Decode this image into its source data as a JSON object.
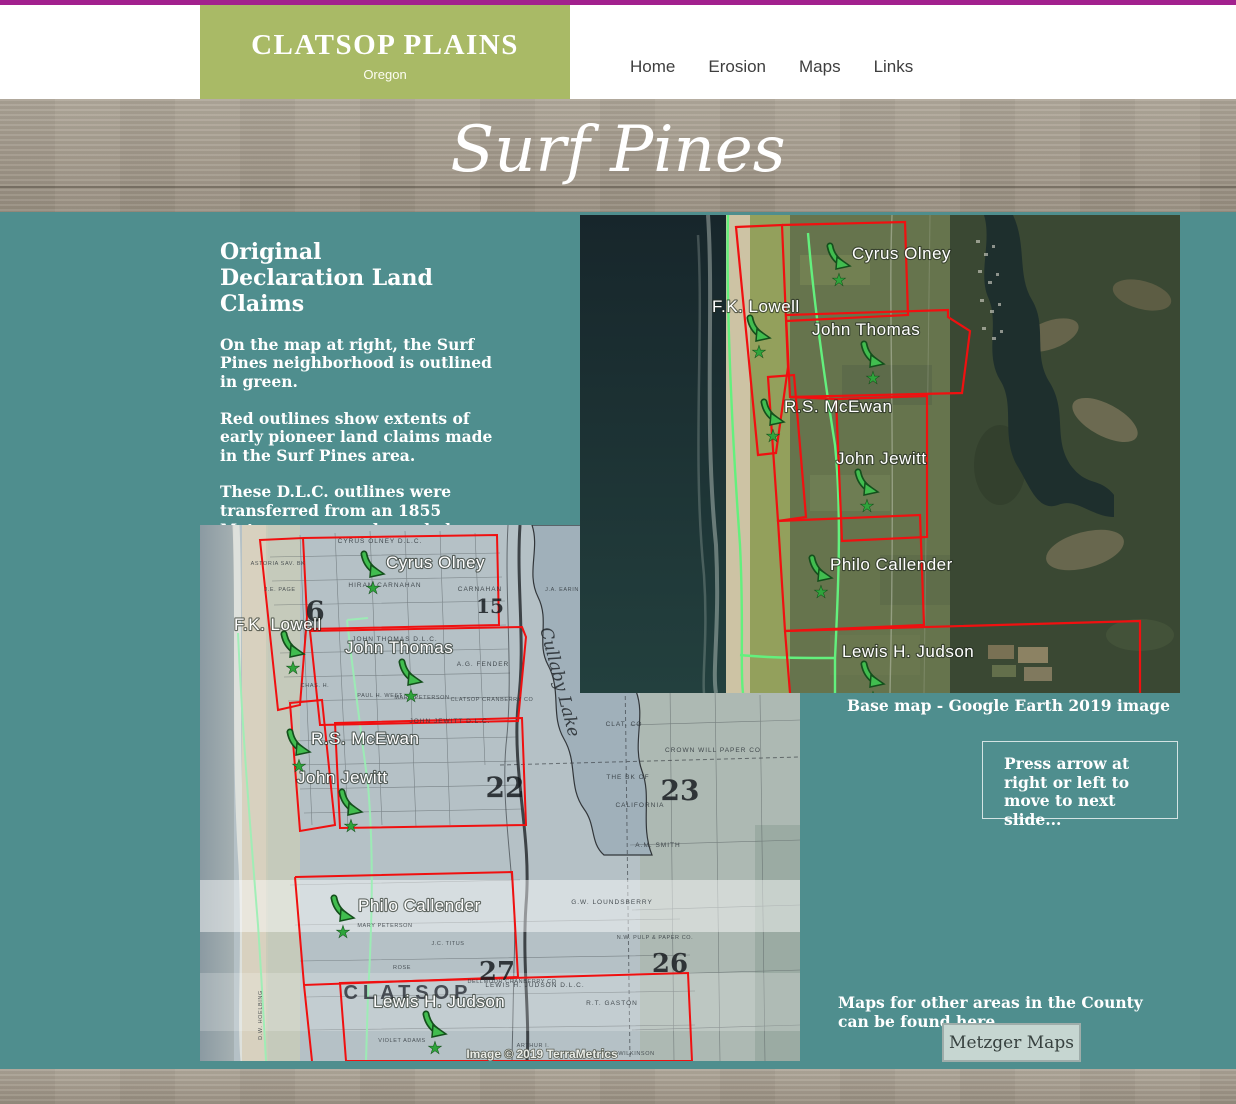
{
  "colors": {
    "teal_bg": "#4f8e8e",
    "olive_brand": "#a9ba66",
    "magenta_topline": "#a2218e",
    "wood": "#a59d90",
    "claim_red": "#f01010",
    "neighborhood_green": "#63f07d",
    "button_bg": "#c6d6d1",
    "button_border": "#9fadaa"
  },
  "header": {
    "brand_title": "CLATSOP PLAINS",
    "brand_subtitle": "Oregon",
    "nav_items": [
      "Home",
      "Erosion",
      "Maps",
      "Links"
    ]
  },
  "banner": {
    "title": "Surf Pines"
  },
  "article": {
    "heading_line1": "Original",
    "heading_line2": "Declaration Land Claims",
    "paragraphs": [
      "On the map at right, the Surf Pines neighborhood is outlined in green.",
      "Red outlines show extents of early pioneer land claims made in the Surf Pines area.",
      "These D.L.C. outlines were transferred from an 1855 Metzger map as shown below. Secondary land owners are also noted on that map."
    ]
  },
  "claims": [
    "Cyrus Olney",
    "F.K. Lowell",
    "John Thomas",
    "R.S. McEwan",
    "John Jewitt",
    "Philo Callender",
    "Lewis H. Judson"
  ],
  "satellite_map": {
    "caption": "Base map - Google Earth 2019 image"
  },
  "metzger_map": {
    "credit": "Image © 2019 TerraMetrics",
    "annotations": [
      "CYRUS OLNEY D.L.C.",
      "ASTORIA SAV. BK",
      "J.E. PAGE",
      "HIRAM CARNAHAN",
      "CARNAHAN",
      "6",
      "15",
      "J.A. EARIN",
      "JOHN THOMAS D.L.C.",
      "A.G. FENDER",
      "CHAS. H.",
      "PAUL H. WEST",
      "MARY PETERSON",
      "CLATSOP CRANBERRY CO",
      "Cullaby Lake",
      "JOHN JEWITT D.L.C.",
      "22",
      "23",
      "CLAT. CO",
      "CROWN WILL PAPER CO",
      "THE BK OF",
      "CALIFORNIA",
      "A.M. SMITH",
      "G.W. LOUNDSBERRY",
      "N.W. PULP & PAPER CO.",
      "26",
      "27",
      "R.T. GASTON",
      "MARY PETERSON",
      "J.C. TITUS",
      "ROSE",
      "CLATSOP",
      "DELLMOOR CRANBERRY CO",
      "LEWIS H. JUDSON D.L.C.",
      "VIOLET ADAMS",
      "ARTHUR I.",
      "JNO. WILKINSON",
      "D.W. HOELBING"
    ]
  },
  "slide_hint": "Press arrow at right or left to move to next slide...",
  "other_maps": {
    "text": "Maps for other areas in the County can be found here...",
    "button_label": "Metzger Maps"
  },
  "icons": {
    "star": "★"
  }
}
